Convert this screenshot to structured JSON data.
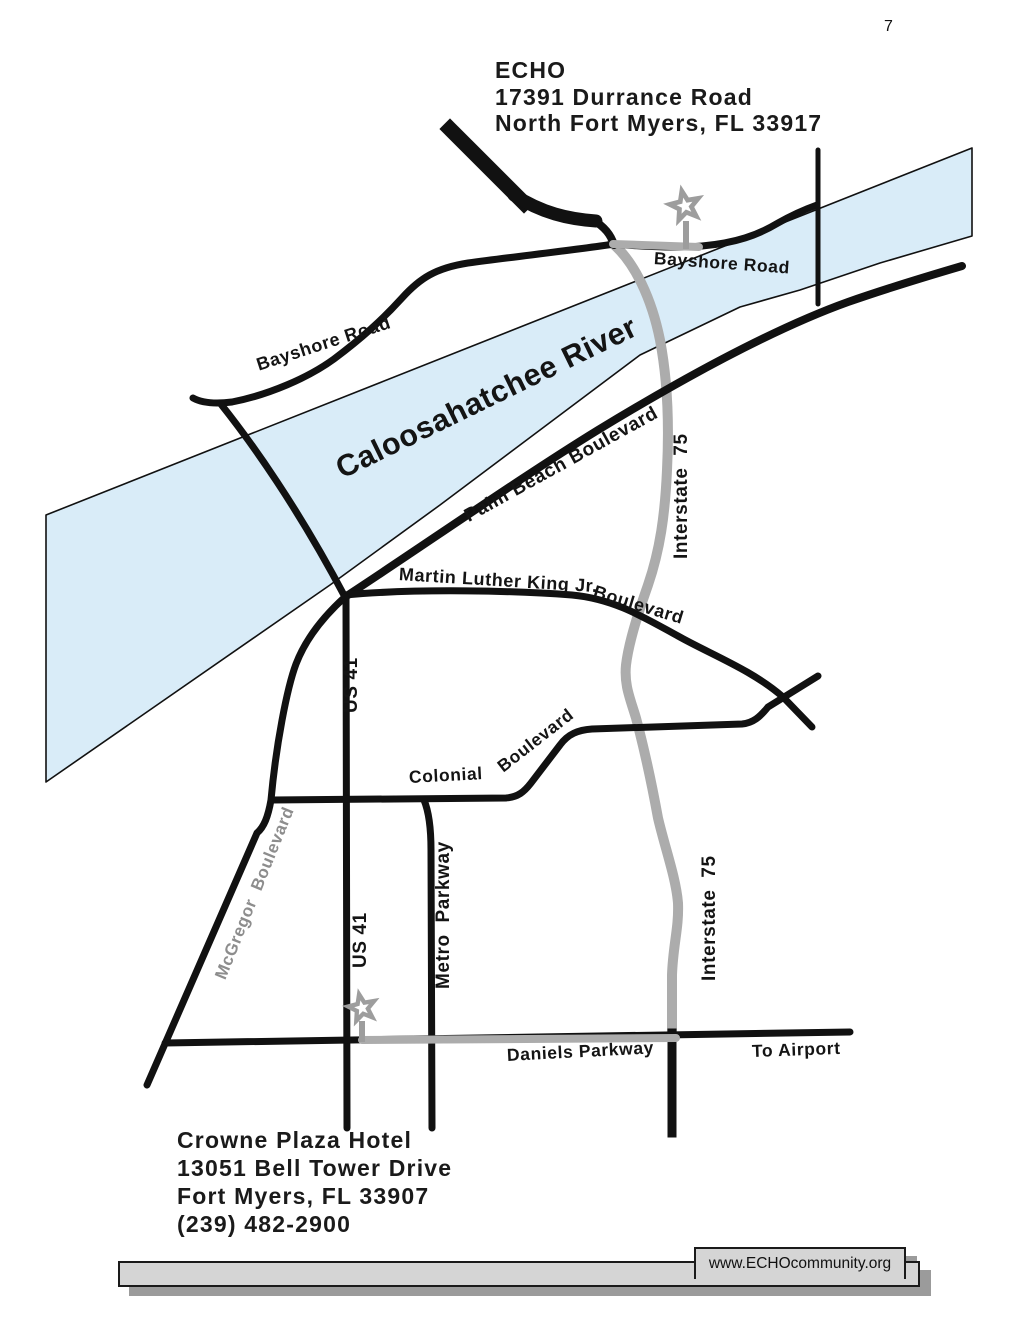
{
  "page": {
    "number": "7"
  },
  "header": {
    "org": "ECHO",
    "address1": "17391 Durrance Road",
    "address2": "North Fort Myers, FL 33917"
  },
  "map": {
    "labels": {
      "bayshore_east": "Bayshore Road",
      "bayshore_west": "Bayshore Road",
      "river": "Caloosahatchee River",
      "palm_beach": "Palm Beach Boulevard",
      "mlk": "Martin Luther King Jr.",
      "mlk_blvd": "Boulevard",
      "interstate_top": "Interstate  75",
      "interstate_bottom": "Interstate  75",
      "us41_top": "US 41",
      "us41_bottom": "US 41",
      "metro": "Metro  Parkway",
      "mcgregor": "McGregor  Boulevard",
      "colonial": "Colonial",
      "colonial_blvd": "Boulevard",
      "daniels": "Daniels Parkway",
      "to_airport": "To Airport"
    },
    "markers": {
      "echo_star": "ECHO location star",
      "hotel_star": "Crowne Plaza Hotel location star"
    },
    "colors": {
      "river": "#d9ecf8",
      "route": "#acacac",
      "star": "#9d9d9d",
      "road": "#111111"
    }
  },
  "hotel": {
    "name": "Crowne Plaza Hotel",
    "address1": "13051 Bell Tower Drive",
    "address2": "Fort Myers, FL 33907",
    "phone": "(239) 482-2900"
  },
  "footer": {
    "url": "www.ECHOcommunity.org"
  }
}
